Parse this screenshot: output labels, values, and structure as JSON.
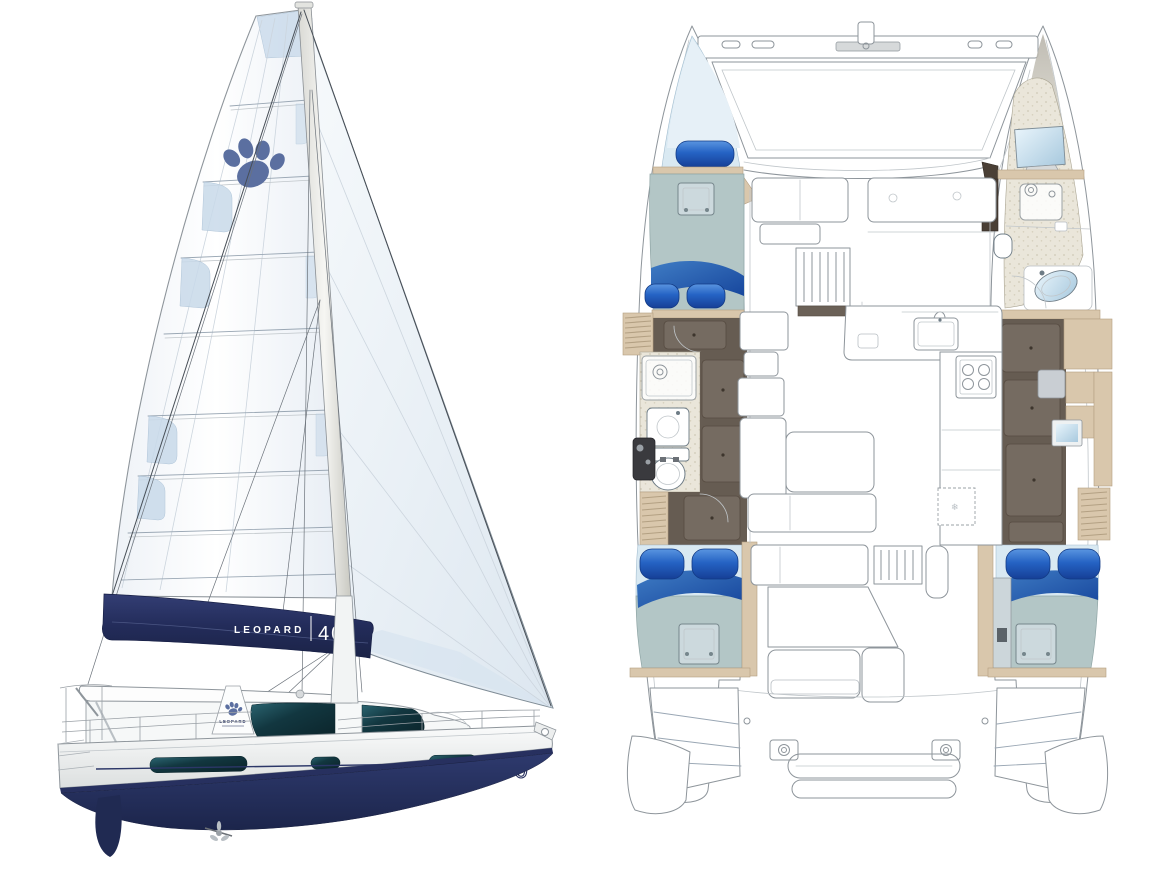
{
  "side_view": {
    "boom_cover": {
      "brand": "LEOPARD",
      "model": "40"
    },
    "hull_bow_label": "40",
    "mast_post_label": "LEOPARD",
    "sail_logo": "paw-print-icon",
    "fridge_symbol": "❄"
  },
  "palette": {
    "navy": "#27305f",
    "navy_dark": "#1d2548",
    "royal_blue": "#1e52b8",
    "royal_highlight": "#5a95e0",
    "swoosh_blue": "#2a63ae",
    "window_teal": "#123740",
    "sail_shade": "#dfe8f1",
    "sail_tint": "#c9daea",
    "paw_blue": "#5b6fa0",
    "mattress_gray": "#b3c6c6",
    "berth_light": "#d9e9f2",
    "wood_light": "#d9c7ac",
    "wood_dark": "#4a3f35",
    "floor_brown": "#665c52",
    "floor_panel": "#756b61",
    "bath_beige": "#eae6da",
    "fixture_gray": "#c9ced3",
    "outline_gray": "#8e959b",
    "mirror_blue": "#a8c9de"
  }
}
